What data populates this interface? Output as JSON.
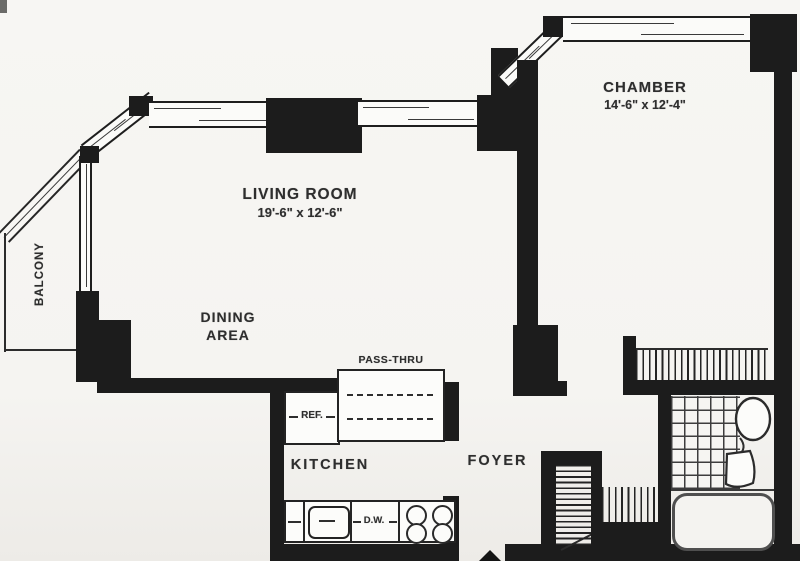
{
  "meta": {
    "type": "apartment floor plan",
    "style": "black-and-white architectural scan"
  },
  "rooms": {
    "living_room": {
      "name": "LIVING ROOM",
      "dims": "19'-6\" x 12'-6\""
    },
    "chamber": {
      "name": "CHAMBER",
      "dims": "14'-6\" x 12'-4\""
    },
    "dining_area": {
      "line1": "DINING",
      "line2": "AREA"
    },
    "kitchen": {
      "name": "KITCHEN"
    },
    "foyer": {
      "name": "FOYER"
    },
    "balcony": {
      "name": "BALCONY"
    }
  },
  "fixtures": {
    "pass_thru": {
      "label": "PASS-THRU"
    },
    "refrigerator": {
      "label": "REF."
    },
    "dishwasher": {
      "label": "D.W."
    }
  },
  "colors": {
    "wall": "#1c1c1c",
    "paper": "#f6f5f2",
    "ink": "#2e2e2e"
  }
}
